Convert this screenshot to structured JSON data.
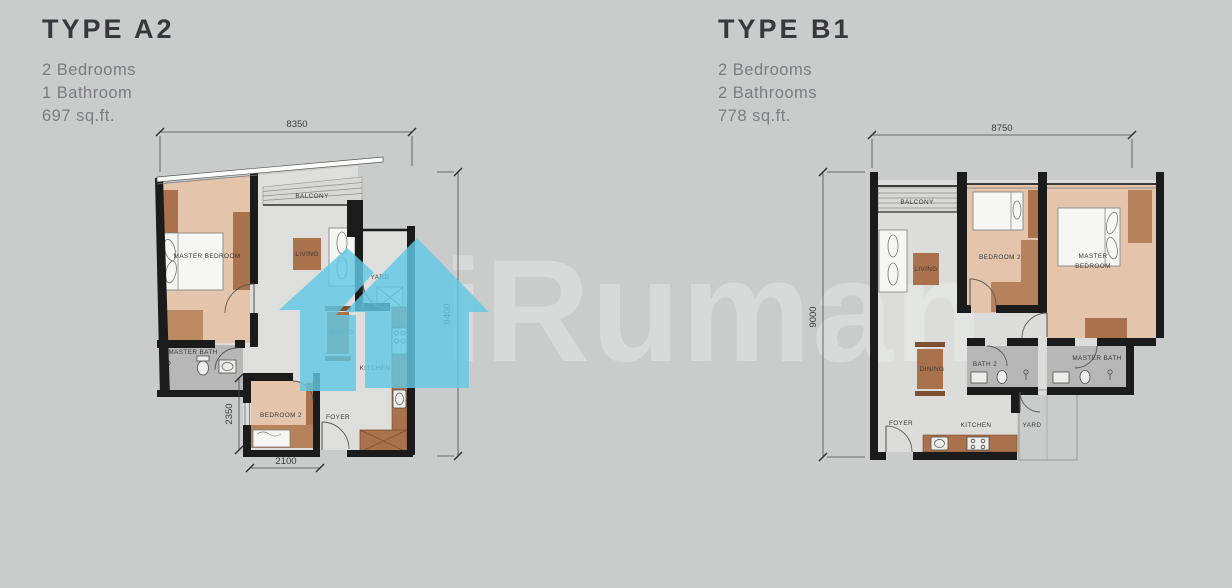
{
  "page": {
    "background": "#CACCCB"
  },
  "watermark": {
    "text": "iRuman",
    "logo": "iruman-house-logo",
    "logo_color": "#61C8E3",
    "text_color": "#D8DAD9"
  },
  "colors": {
    "background": "#CACCCB",
    "wall": "#1B1B1B",
    "bedroom_floor": "#E4C4AA",
    "bath_floor": "#B6B7B6",
    "furniture_brown": "#A9714C",
    "logo_cyan": "#61C8E3",
    "watermark_gray": "#D8DAD9"
  },
  "units": [
    {
      "title": "TYPE A2",
      "specs": [
        "2 Bedrooms",
        "1 Bathroom",
        "697 sq.ft."
      ],
      "rooms": {
        "master_bedroom": "MASTER BEDROOM",
        "balcony": "BALCONY",
        "living": "LIVING",
        "yard": "YARD",
        "dining": "DINING",
        "master_bath": "MASTER BATH",
        "kitchen": "KITCHEN",
        "bedroom2": "BEDROOM 2",
        "foyer": "FOYER"
      },
      "dims": {
        "width": "8350",
        "height": "9400",
        "bedroom2_height": "2350",
        "bedroom2_width": "2100"
      }
    },
    {
      "title": "TYPE B1",
      "specs": [
        "2 Bedrooms",
        "2 Bathrooms",
        "778 sq.ft."
      ],
      "rooms": {
        "balcony": "BALCONY",
        "living": "LIVING",
        "bedroom2": "BEDROOM 2",
        "master_line1": "MASTER",
        "master_line2": "BEDROOM",
        "dining": "DINING",
        "bath2": "BATH 2",
        "master_bath": "MASTER BATH",
        "foyer": "FOYER",
        "kitchen": "KITCHEN",
        "yard": "YARD"
      },
      "dims": {
        "width": "8750",
        "height": "9000"
      }
    }
  ]
}
